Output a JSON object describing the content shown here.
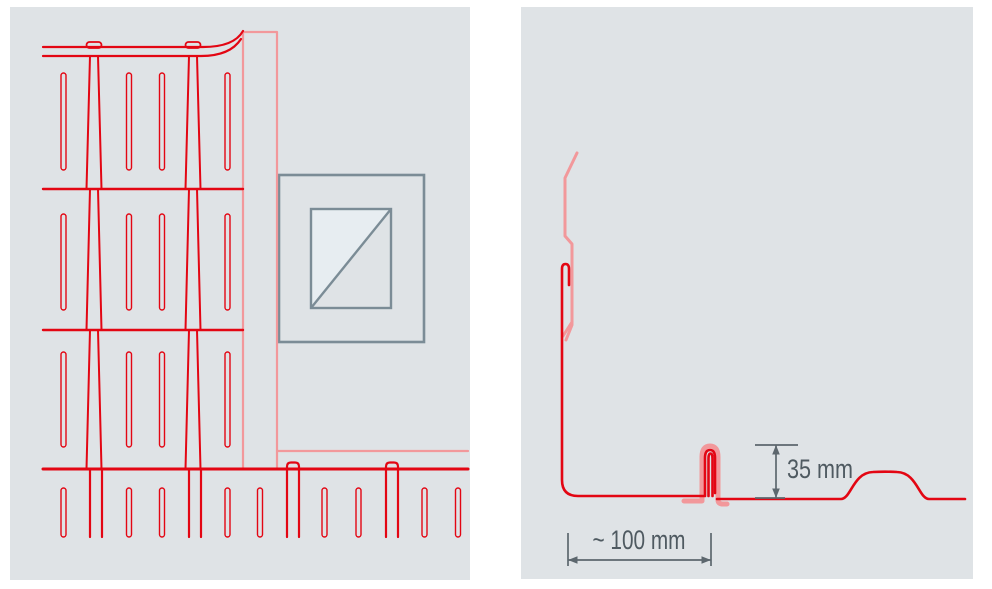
{
  "panels": {
    "background_color": "#dfe3e6",
    "cladding_red": "#e30613",
    "highlight_pink": "#f2989b",
    "dimension_gray": "#5d676e",
    "window_frame_gray": "#7b8c96",
    "glass_color": "#e7edf1"
  },
  "right_panel": {
    "dimensions": {
      "seam_height": "35 mm",
      "flashing_width": "~ 100 mm"
    }
  }
}
